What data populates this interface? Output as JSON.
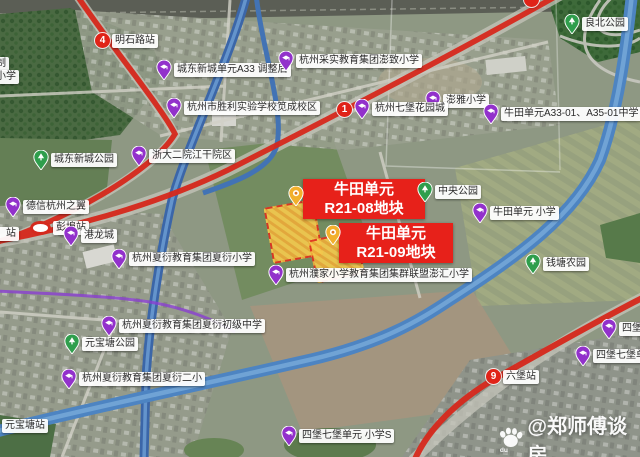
{
  "watermark": {
    "text": "@郑师傅谈房",
    "logo": "baidu-paw-icon",
    "logo_sub": "du"
  },
  "map": {
    "accent_colors": {
      "metro_red": "#d6281c",
      "banner_red": "#e7211a",
      "school_pin": "#9231cb",
      "park_pin": "#2f9e4c",
      "parcel_fill": "#f3c94e",
      "water": "#4d84c2"
    },
    "banners": [
      {
        "name": "banner-r21-08",
        "line1": "牛田单元",
        "line2": "R21-08地块",
        "x": 303,
        "y": 179,
        "w": 114
      },
      {
        "name": "banner-r21-09",
        "line1": "牛田单元",
        "line2": "R21-09地块",
        "x": 339,
        "y": 223,
        "w": 106
      }
    ],
    "parcels": [
      {
        "name": "parcel-r21-08",
        "x": 268,
        "y": 203,
        "w": 47,
        "h": 53,
        "rot": -10
      },
      {
        "name": "parcel-r21-09",
        "x": 312,
        "y": 235,
        "w": 45,
        "h": 40,
        "rot": -12
      }
    ],
    "markers": [
      {
        "name": "station-mingshilu",
        "badge": "4",
        "text": "明石路站",
        "x": 95,
        "y": 33
      },
      {
        "name": "label-chengdong-a33",
        "pin": "purple",
        "text": "城东新城单元A33 调整后",
        "x": 156,
        "y": 60
      },
      {
        "name": "label-shengli-school",
        "pin": "purple",
        "text": "杭州市胜利实验学校笕成校区",
        "x": 166,
        "y": 98
      },
      {
        "name": "label-caishi-school",
        "pin": "purple",
        "text": "杭州采实教育集团澎致小学",
        "x": 278,
        "y": 51
      },
      {
        "name": "label-liangbei-park",
        "pin": "green",
        "text": "良北公园",
        "x": 564,
        "y": 14
      },
      {
        "name": "label-pengya-school",
        "pin": "purple",
        "text": "澎雅小学",
        "x": 425,
        "y": 91
      },
      {
        "name": "station-qibao",
        "badge": "1",
        "pin": "purple",
        "text": "杭州七堡花园城",
        "x": 337,
        "y": 99
      },
      {
        "name": "label-niutian-a33-school",
        "pin": "purple",
        "text": "牛田单元A33-01、A35-01中学",
        "x": 483,
        "y": 104
      },
      {
        "name": "label-zheda-hospital",
        "pin": "purple",
        "text": "浙大二院江干院区",
        "x": 131,
        "y": 146
      },
      {
        "name": "label-chengdong-park",
        "pin": "green",
        "text": "城东新城公园",
        "x": 33,
        "y": 150
      },
      {
        "name": "label-central-park",
        "pin": "green",
        "text": "中央公园",
        "x": 417,
        "y": 182
      },
      {
        "name": "label-niutian-primary",
        "pin": "purple",
        "text": "牛田单元 小学",
        "x": 472,
        "y": 203
      },
      {
        "name": "label-dexin-wing",
        "pin": "purple",
        "text": "德信杭州之翼",
        "x": 5,
        "y": 197
      },
      {
        "name": "station-pengbu",
        "oval": true,
        "text": "彭埠站",
        "x": 30,
        "y": 221
      },
      {
        "name": "label-partial-zhan",
        "text": "）站",
        "x": -7,
        "y": 227
      },
      {
        "name": "label-ganglongcheng",
        "pin": "purple",
        "text": "港龙城",
        "x": 63,
        "y": 226
      },
      {
        "name": "label-qiantang-farm",
        "pin": "green",
        "text": "钱塘农园",
        "x": 525,
        "y": 254
      },
      {
        "name": "label-xiayan-primary",
        "pin": "purple",
        "text": "杭州夏衍教育集团夏衍小学",
        "x": 111,
        "y": 249
      },
      {
        "name": "label-pujia-penghui",
        "pin": "purple",
        "text": "杭州濮家小学教育集团集群联盟澎汇小学",
        "x": 268,
        "y": 265
      },
      {
        "name": "label-xiayan-junior",
        "pin": "purple",
        "text": "杭州夏衍教育集团夏衍初级中学",
        "x": 101,
        "y": 316
      },
      {
        "name": "label-yuanbaotang-park",
        "pin": "green",
        "text": "元宝塘公园",
        "x": 64,
        "y": 334
      },
      {
        "name": "label-xiayan-second",
        "pin": "purple",
        "text": "杭州夏衍教育集团夏衍二小",
        "x": 61,
        "y": 369
      },
      {
        "name": "station-yuanbaotang",
        "text": "元宝塘站",
        "x": 2,
        "y": 419
      },
      {
        "name": "station-liubao",
        "badge": "9",
        "text": "六堡站",
        "x": 486,
        "y": 369
      },
      {
        "name": "label-sibaoqibao-primary",
        "pin": "purple",
        "text": "四堡七堡单元 小学S",
        "x": 281,
        "y": 426
      },
      {
        "name": "label-sibaoqibao-junior",
        "pin": "purple",
        "text": "四堡七堡单元 初中",
        "x": 575,
        "y": 346
      },
      {
        "name": "label-sibaoqibao-partial",
        "pin": "purple",
        "text": "四堡七堡",
        "x": 601,
        "y": 319
      },
      {
        "name": "label-partial-zhi",
        "text": "制",
        "x": -7,
        "y": 57
      },
      {
        "name": "label-partial-xiaoxue",
        "text": "小学",
        "x": -7,
        "y": 70
      },
      {
        "name": "parcel-pin-r21-08",
        "pin": "yellow",
        "text": "",
        "x": 288,
        "y": 186
      },
      {
        "name": "parcel-pin-r21-09",
        "pin": "yellow",
        "text": "",
        "x": 325,
        "y": 225
      },
      {
        "name": "station-badge-partial",
        "badge": " ",
        "text": "",
        "x": 524,
        "y": -8
      }
    ]
  }
}
